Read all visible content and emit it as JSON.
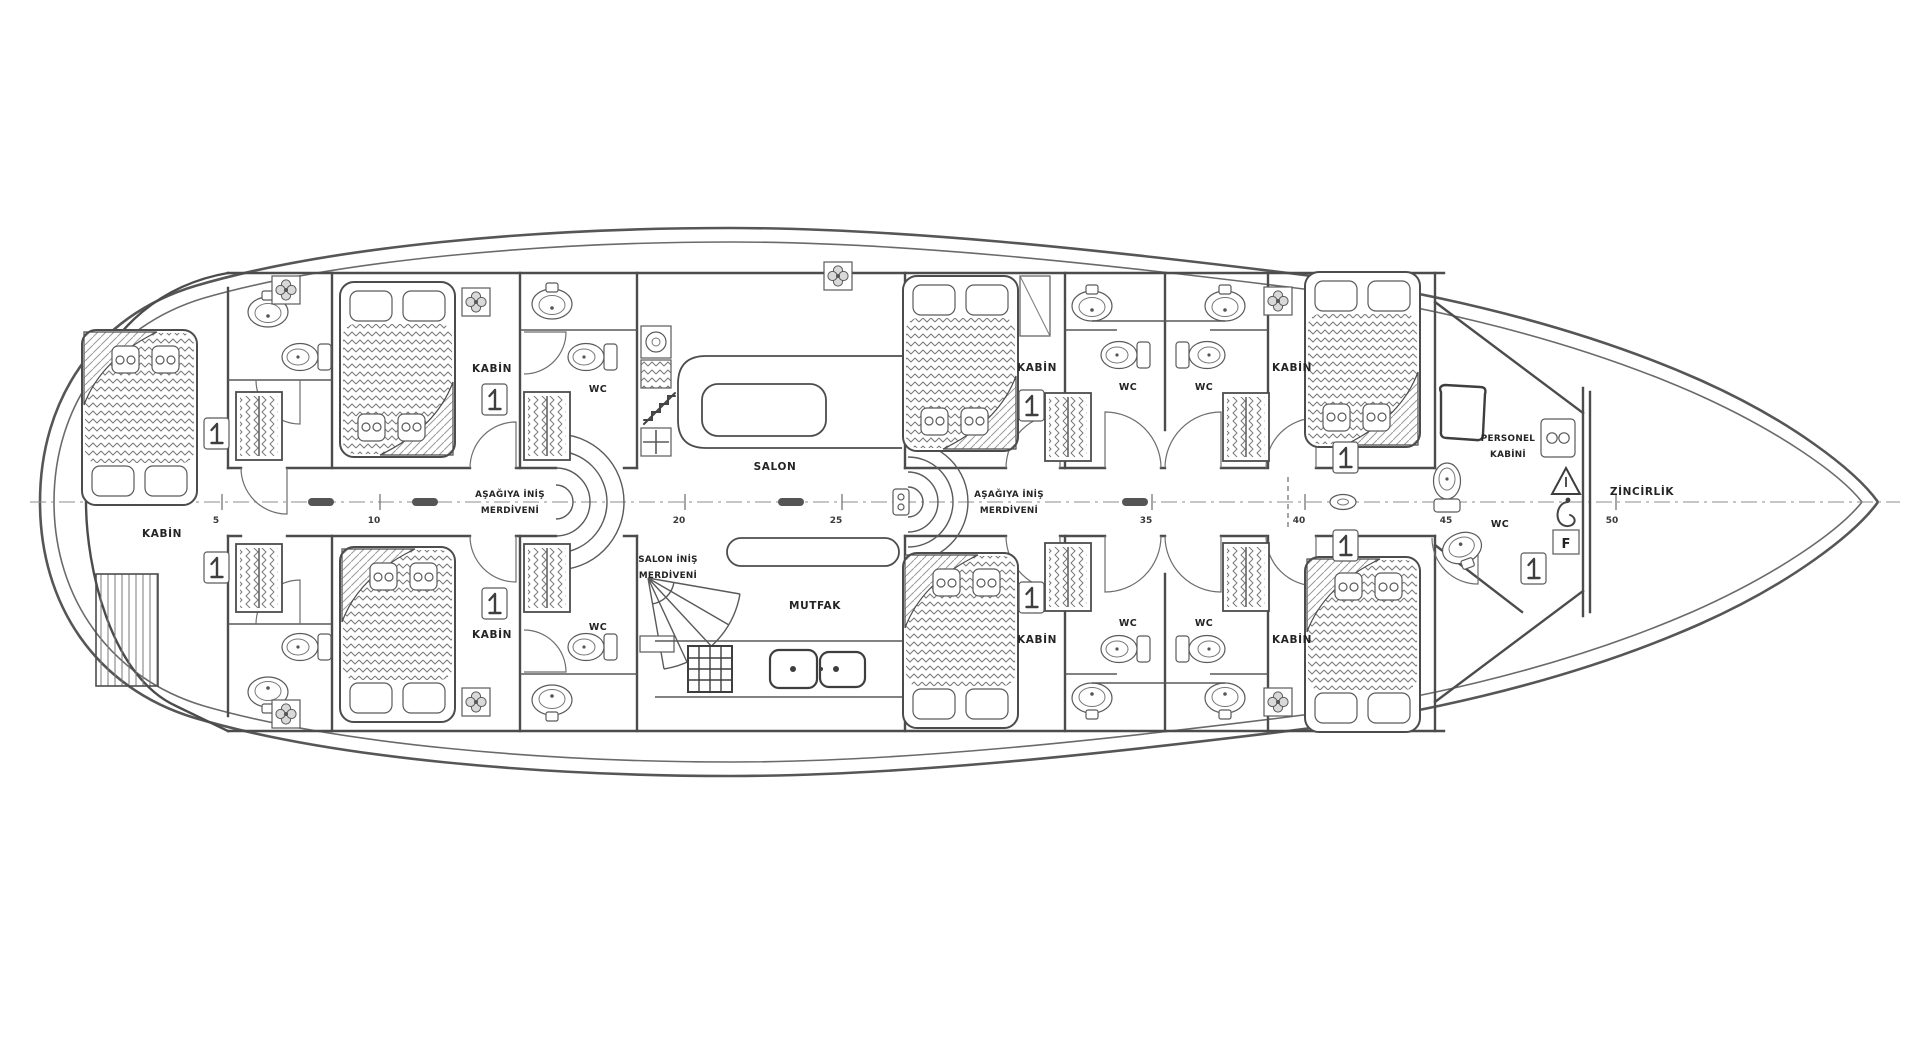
{
  "plan": {
    "cabin_label": "KABİN",
    "wc_label": "WC",
    "salon_label": "SALON",
    "galley_label": "MUTFAK",
    "stairs_down_line1": "AŞAĞIYA İNİŞ",
    "stairs_down_line2": "MERDİVENİ",
    "salon_stairs_line1": "SALON İNİŞ",
    "salon_stairs_line2": "MERDİVENİ",
    "crew_cabin_line1": "PERSONEL",
    "crew_cabin_line2": "KABİNİ",
    "chain_locker_label": "ZİNCİRLİK",
    "fire_box_label": "F",
    "scale_marks": [
      "5",
      "10",
      "20",
      "25",
      "35",
      "40",
      "45",
      "50"
    ]
  },
  "colors": {
    "line": "#4c4c4c",
    "text": "#242424",
    "background": "#ffffff"
  }
}
